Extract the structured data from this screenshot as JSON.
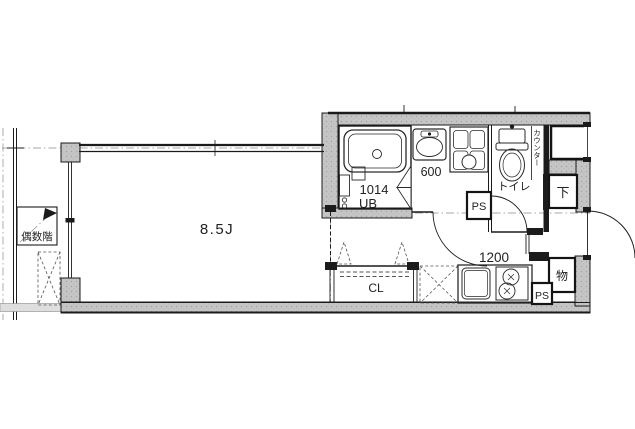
{
  "labels": {
    "floor_note": "偶数階",
    "main_room_size": "8.5J",
    "unit_bath_model": "1014",
    "unit_bath": "UB",
    "vanity_width": "600",
    "toilet": "トイレ",
    "counter": "カウンター",
    "ps_washroom": "PS",
    "shoe_box": "下",
    "closet": "CL",
    "kitchen_width": "1200",
    "storage": "物",
    "ps_kitchen": "PS"
  },
  "colors": {
    "wall_fill": "#c7c7c7",
    "line": "#1b1b1b",
    "background": "#ffffff"
  }
}
